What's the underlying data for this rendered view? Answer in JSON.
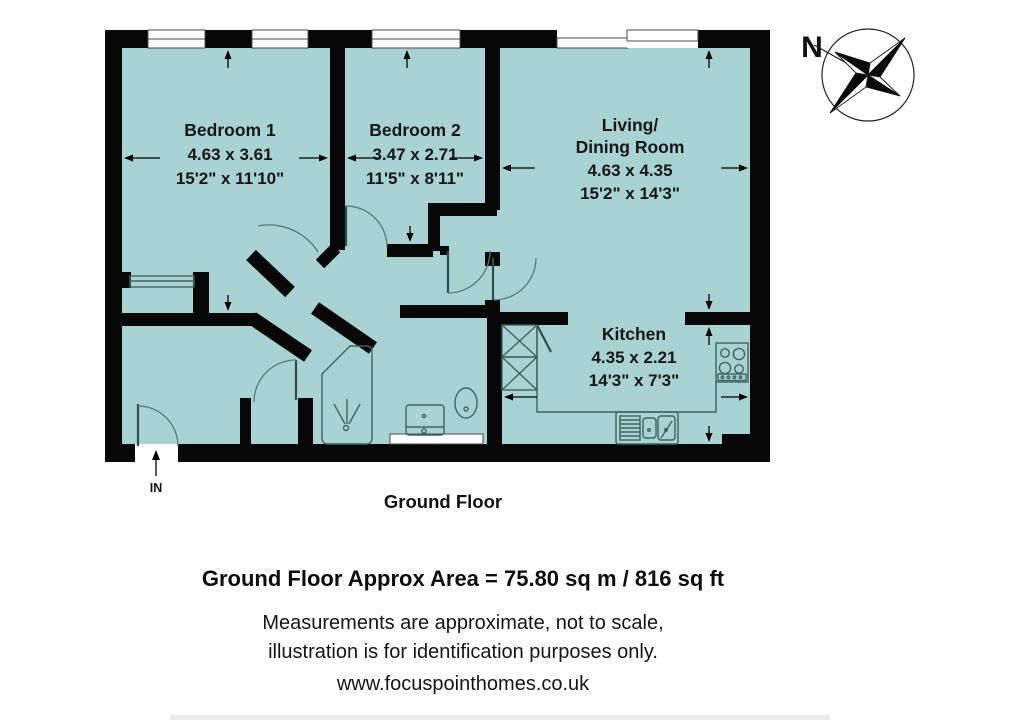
{
  "plan": {
    "rooms": [
      {
        "name": "Bedroom 1",
        "metric": "4.63 x 3.61",
        "imperial": "15'2\" x 11'10\""
      },
      {
        "name": "Bedroom 2",
        "metric": "3.47 x 2.71",
        "imperial": "11'5\" x 8'11\""
      },
      {
        "name_line1": "Living/",
        "name_line2": "Dining Room",
        "metric": "4.63 x 4.35",
        "imperial": "15'2\" x 14'3\""
      },
      {
        "name": "Kitchen",
        "metric": "4.35 x 2.21",
        "imperial": "14'3\" x 7'3\""
      }
    ],
    "floor_label": "Ground Floor",
    "entrance_label": "IN",
    "compass_north_label": "N"
  },
  "footer": {
    "area_summary": "Ground Floor Approx Area = 75.80 sq m / 816 sq ft",
    "disclaimer_line1": "Measurements are approximate, not to scale,",
    "disclaimer_line2": "illustration is for identification purposes only.",
    "website": "www.focuspointhomes.co.uk"
  },
  "colors": {
    "floor_fill": "#a8d3d2",
    "wall": "#070707",
    "fixture_line": "#3f6363",
    "background": "#ffffff"
  },
  "icons": [
    "compass-rose-icon",
    "entry-arrow-icon",
    "shower-icon",
    "toilet-icon",
    "washbasin-icon",
    "hob-icon",
    "kitchen-sink-icon",
    "wardrobe-icon",
    "window-icon",
    "door-arc-icon",
    "dimension-arrow-icon",
    "cupboard-icon"
  ]
}
